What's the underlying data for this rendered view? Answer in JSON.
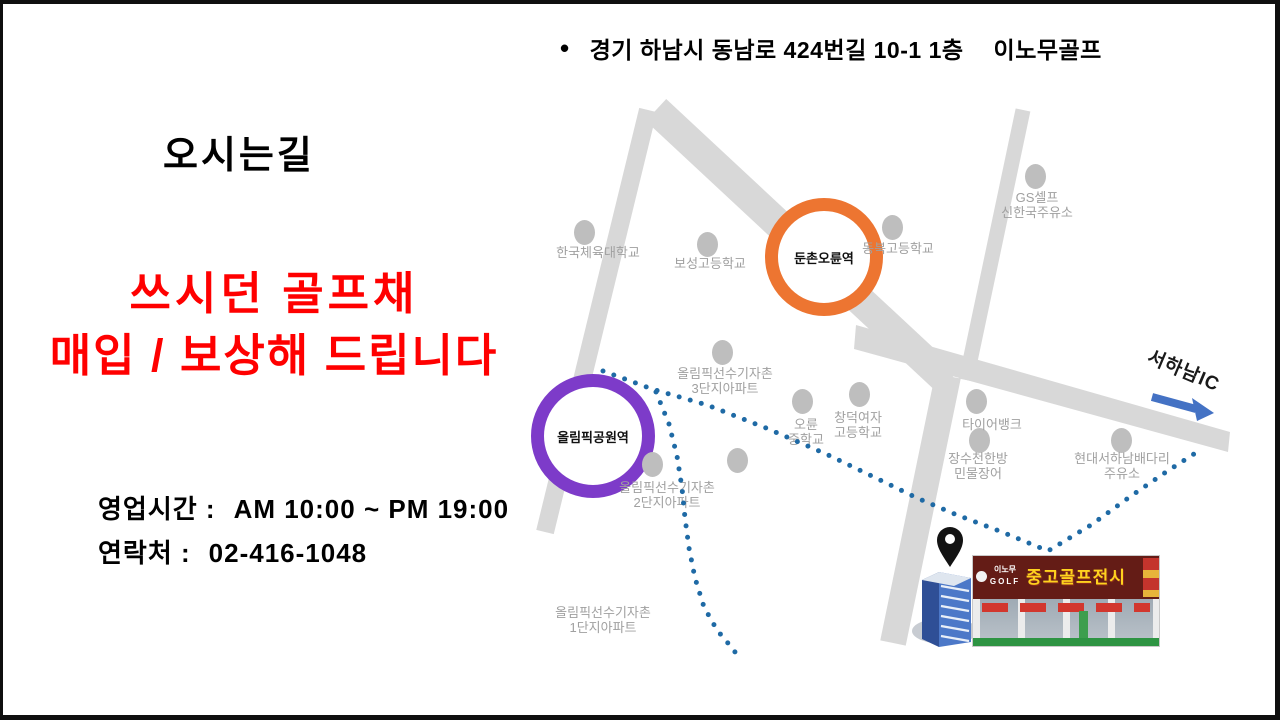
{
  "slide": {
    "address": {
      "bullet": "•",
      "text": "경기 하남시 동남로 424번길 10-1 1층",
      "brand": "이노무골프"
    },
    "heading": "오시는길",
    "promo": {
      "line1": "쓰시던 골프채",
      "line2": "매입 / 보상해 드립니다",
      "color": "#FF0000"
    },
    "hours": {
      "label": "영업시간 :",
      "value": "AM 10:00 ~ PM 19:00"
    },
    "contact": {
      "label": "연락처 :",
      "value": "02-416-1048"
    }
  },
  "map": {
    "road_color": "#D8D8D8",
    "route_color": "#1F6AA5",
    "arrow_color": "#4472C4",
    "stations": [
      {
        "name": "둔촌오륜역",
        "ring_color": "#ED7531"
      },
      {
        "name": "올림픽공원역",
        "ring_color": "#7D3BC9"
      }
    ],
    "pois": [
      {
        "line1": "한국체육대학교"
      },
      {
        "line1": "보성고등학교"
      },
      {
        "line1": "동북고등학교"
      },
      {
        "line1": "GS셀프",
        "line2": "신한국주유소"
      },
      {
        "line1": "올림픽선수기자촌",
        "line2": "3단지아파트"
      },
      {
        "line1": "오륜",
        "line2": "중학교"
      },
      {
        "line1": "창덕여자",
        "line2": "고등학교"
      },
      {
        "line1": "올림픽선수기자촌",
        "line2": "2단지아파트"
      },
      {
        "line1": "타이어뱅크"
      },
      {
        "line1": "장수천한방",
        "line2": "민물장어"
      },
      {
        "line1": "현대서하남배다리",
        "line2": "주유소"
      },
      {
        "line1": "올림픽선수기자촌",
        "line2": "1단지아파트"
      }
    ],
    "ic_label": "서하남IC",
    "shop_sign": {
      "brand_line1": "이노무",
      "brand_line2": "GOLF",
      "title": "중고골프전시장"
    }
  }
}
